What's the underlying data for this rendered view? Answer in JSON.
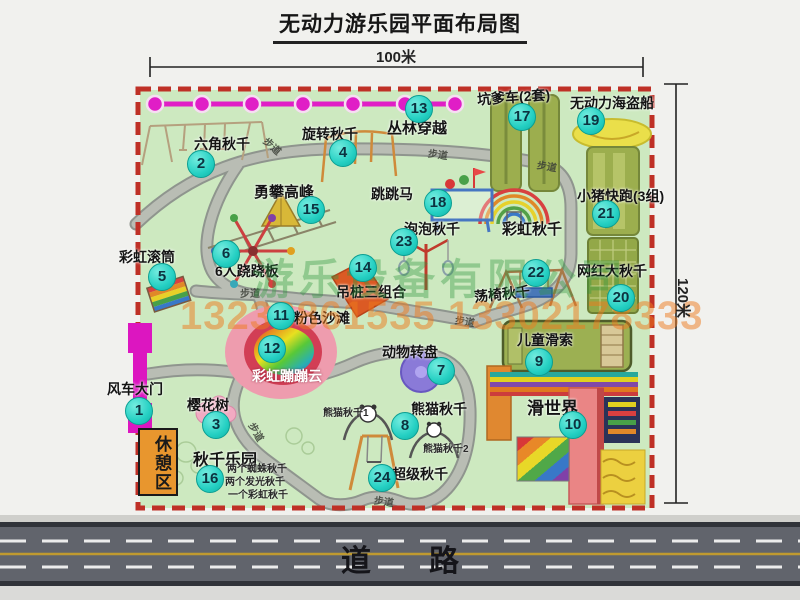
{
  "title": "无动力游乐园平面布局图",
  "dimensions": {
    "top": "100米",
    "right": "120米"
  },
  "road_label": "道路",
  "rest_area_label": "休憩区",
  "watermark": {
    "company": "游乐设备有限公司",
    "phone": "13233861535 13302178333"
  },
  "attractions": [
    {
      "num": 1,
      "label": "风车大门",
      "cx": 138,
      "cy": 410,
      "lx": 107,
      "ly": 379
    },
    {
      "num": 2,
      "label": "六角秋千",
      "cx": 200,
      "cy": 163,
      "lx": 194,
      "ly": 134
    },
    {
      "num": 3,
      "label": "樱花树",
      "cx": 215,
      "cy": 424,
      "lx": 187,
      "ly": 395
    },
    {
      "num": 4,
      "label": "旋转秋千",
      "cx": 342,
      "cy": 152,
      "lx": 302,
      "ly": 124
    },
    {
      "num": 5,
      "label": "彩虹滚筒",
      "cx": 161,
      "cy": 276,
      "lx": 119,
      "ly": 247
    },
    {
      "num": 6,
      "label": "6人跷跷板",
      "cx": 225,
      "cy": 253,
      "lx": 215,
      "ly": 261
    },
    {
      "num": 7,
      "label": "动物转盘",
      "cx": 440,
      "cy": 370,
      "lx": 382,
      "ly": 342
    },
    {
      "num": 8,
      "label": "熊猫秋千",
      "cx": 404,
      "cy": 425,
      "lx": 411,
      "ly": 399
    },
    {
      "num": 9,
      "label": "儿童滑索",
      "cx": 538,
      "cy": 361,
      "lx": 517,
      "ly": 330
    },
    {
      "num": 10,
      "label": "滑世界",
      "cx": 572,
      "cy": 424,
      "lx": 527,
      "ly": 394,
      "size": 17
    },
    {
      "num": 11,
      "label": "粉色沙滩",
      "cx": 280,
      "cy": 315,
      "lx": 294,
      "ly": 308
    },
    {
      "num": 12,
      "label": "彩虹蹦蹦云",
      "cx": 271,
      "cy": 348,
      "lx": 252,
      "ly": 366,
      "variant": "white"
    },
    {
      "num": 13,
      "label": "丛林穿越",
      "cx": 418,
      "cy": 108,
      "lx": 387,
      "ly": 117,
      "size": 15
    },
    {
      "num": 14,
      "label": "吊桩三组合",
      "cx": 362,
      "cy": 267,
      "lx": 336,
      "ly": 282
    },
    {
      "num": 15,
      "label": "勇攀高峰",
      "cx": 310,
      "cy": 209,
      "lx": 254,
      "ly": 181,
      "size": 15
    },
    {
      "num": 16,
      "label": "秋千乐园",
      "cx": 209,
      "cy": 478,
      "lx": 193,
      "ly": 446,
      "size": 16
    },
    {
      "num": 17,
      "label": "坑爹车(2套)",
      "cx": 521,
      "cy": 116,
      "lx": 477,
      "ly": 87,
      "rot": -4
    },
    {
      "num": 18,
      "label": "跳跳马",
      "cx": 437,
      "cy": 202,
      "lx": 371,
      "ly": 184
    },
    {
      "num": 19,
      "label": "无动力海盗船",
      "cx": 590,
      "cy": 120,
      "lx": 570,
      "ly": 93
    },
    {
      "num": 20,
      "label": "网红大秋千",
      "cx": 620,
      "cy": 297,
      "lx": 577,
      "ly": 261
    },
    {
      "num": 21,
      "label": "小猪快跑(3组)",
      "cx": 605,
      "cy": 213,
      "lx": 577,
      "ly": 186
    },
    {
      "num": 22,
      "label": "荡椅秋千",
      "cx": 535,
      "cy": 272,
      "lx": 474,
      "ly": 284,
      "rot": -6
    },
    {
      "num": 23,
      "label": "泡泡秋千",
      "cx": 403,
      "cy": 241,
      "lx": 404,
      "ly": 219
    },
    {
      "num": 24,
      "label": "超级秋千",
      "cx": 381,
      "cy": 477,
      "lx": 392,
      "ly": 464
    }
  ],
  "extra_labels": [
    {
      "text": "彩虹秋千",
      "x": 502,
      "y": 218,
      "size": 15
    }
  ],
  "sub_labels": [
    {
      "text": "熊猫秋千1",
      "x": 323,
      "y": 404
    },
    {
      "text": "熊猫秋千2",
      "x": 423,
      "y": 440
    },
    {
      "text": "两个蜘蛛秋千",
      "x": 227,
      "y": 460
    },
    {
      "text": "两个发光秋千",
      "x": 225,
      "y": 473
    },
    {
      "text": "一个彩虹秋千",
      "x": 228,
      "y": 486
    }
  ],
  "path_labels": [
    {
      "text": "步道",
      "x": 263,
      "y": 138,
      "rot": 42
    },
    {
      "text": "步道",
      "x": 428,
      "y": 146,
      "rot": 8
    },
    {
      "text": "步道",
      "x": 537,
      "y": 158,
      "rot": 10
    },
    {
      "text": "步道",
      "x": 240,
      "y": 285,
      "rot": 0
    },
    {
      "text": "步道",
      "x": 455,
      "y": 313,
      "rot": 10
    },
    {
      "text": "步道",
      "x": 247,
      "y": 424,
      "rot": 60
    },
    {
      "text": "步道",
      "x": 374,
      "y": 493,
      "rot": 8
    }
  ],
  "colors": {
    "park_green": "#cde9c0",
    "path_gray": "#9ba19a",
    "dashed_border_red": "#bf3026",
    "marker_teal": "#25d0c3",
    "zipline_magenta": "#e01ec6",
    "gate_magenta": "#dc16c0",
    "rest_area_orange": "#e8962e",
    "olive_equipment": "#9cae4e",
    "road_gray": "#61646c"
  }
}
